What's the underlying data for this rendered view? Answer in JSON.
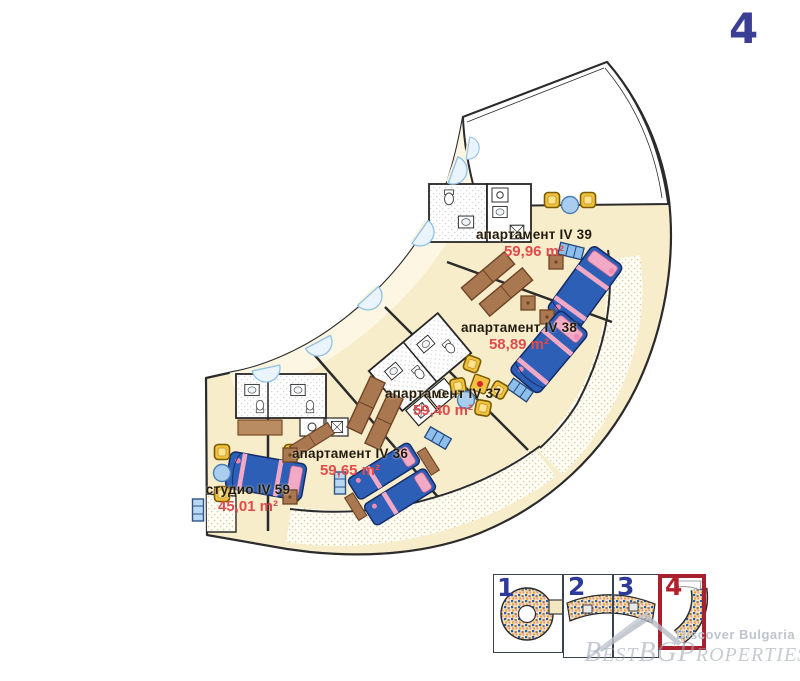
{
  "page": {
    "floor_number": "4"
  },
  "plan": {
    "units": [
      {
        "id": "apt39",
        "name": "апартамент IV 39",
        "area": "59,96 m²"
      },
      {
        "id": "apt38",
        "name": "апартамент IV 38",
        "area": "58,89 m²"
      },
      {
        "id": "apt37",
        "name": "апартамент IV 37",
        "area": "59,40 m²"
      },
      {
        "id": "apt36",
        "name": "апартамент IV 36",
        "area": "59,65 m²"
      },
      {
        "id": "studio59",
        "name": "студио IV 59",
        "area": "45,01 m²"
      }
    ]
  },
  "floor_selector": {
    "items": [
      {
        "label": "1",
        "selected": false
      },
      {
        "label": "2",
        "selected": false
      },
      {
        "label": "3",
        "selected": false
      },
      {
        "label": "4",
        "selected": true
      }
    ]
  },
  "watermark": {
    "tagline": "Discover Bulgaria",
    "brand": "BestBGProperties"
  },
  "colors": {
    "accent_blue": "#3a3f94",
    "accent_red": "#b2202c",
    "area_text": "#e04b4b",
    "floor_fill": "#f8edca",
    "bed_blue": "#2e5fb7",
    "furniture_brown": "#aa7850",
    "chair_yellow": "#f2c23e",
    "pillow_pink": "#f2a9c6"
  }
}
